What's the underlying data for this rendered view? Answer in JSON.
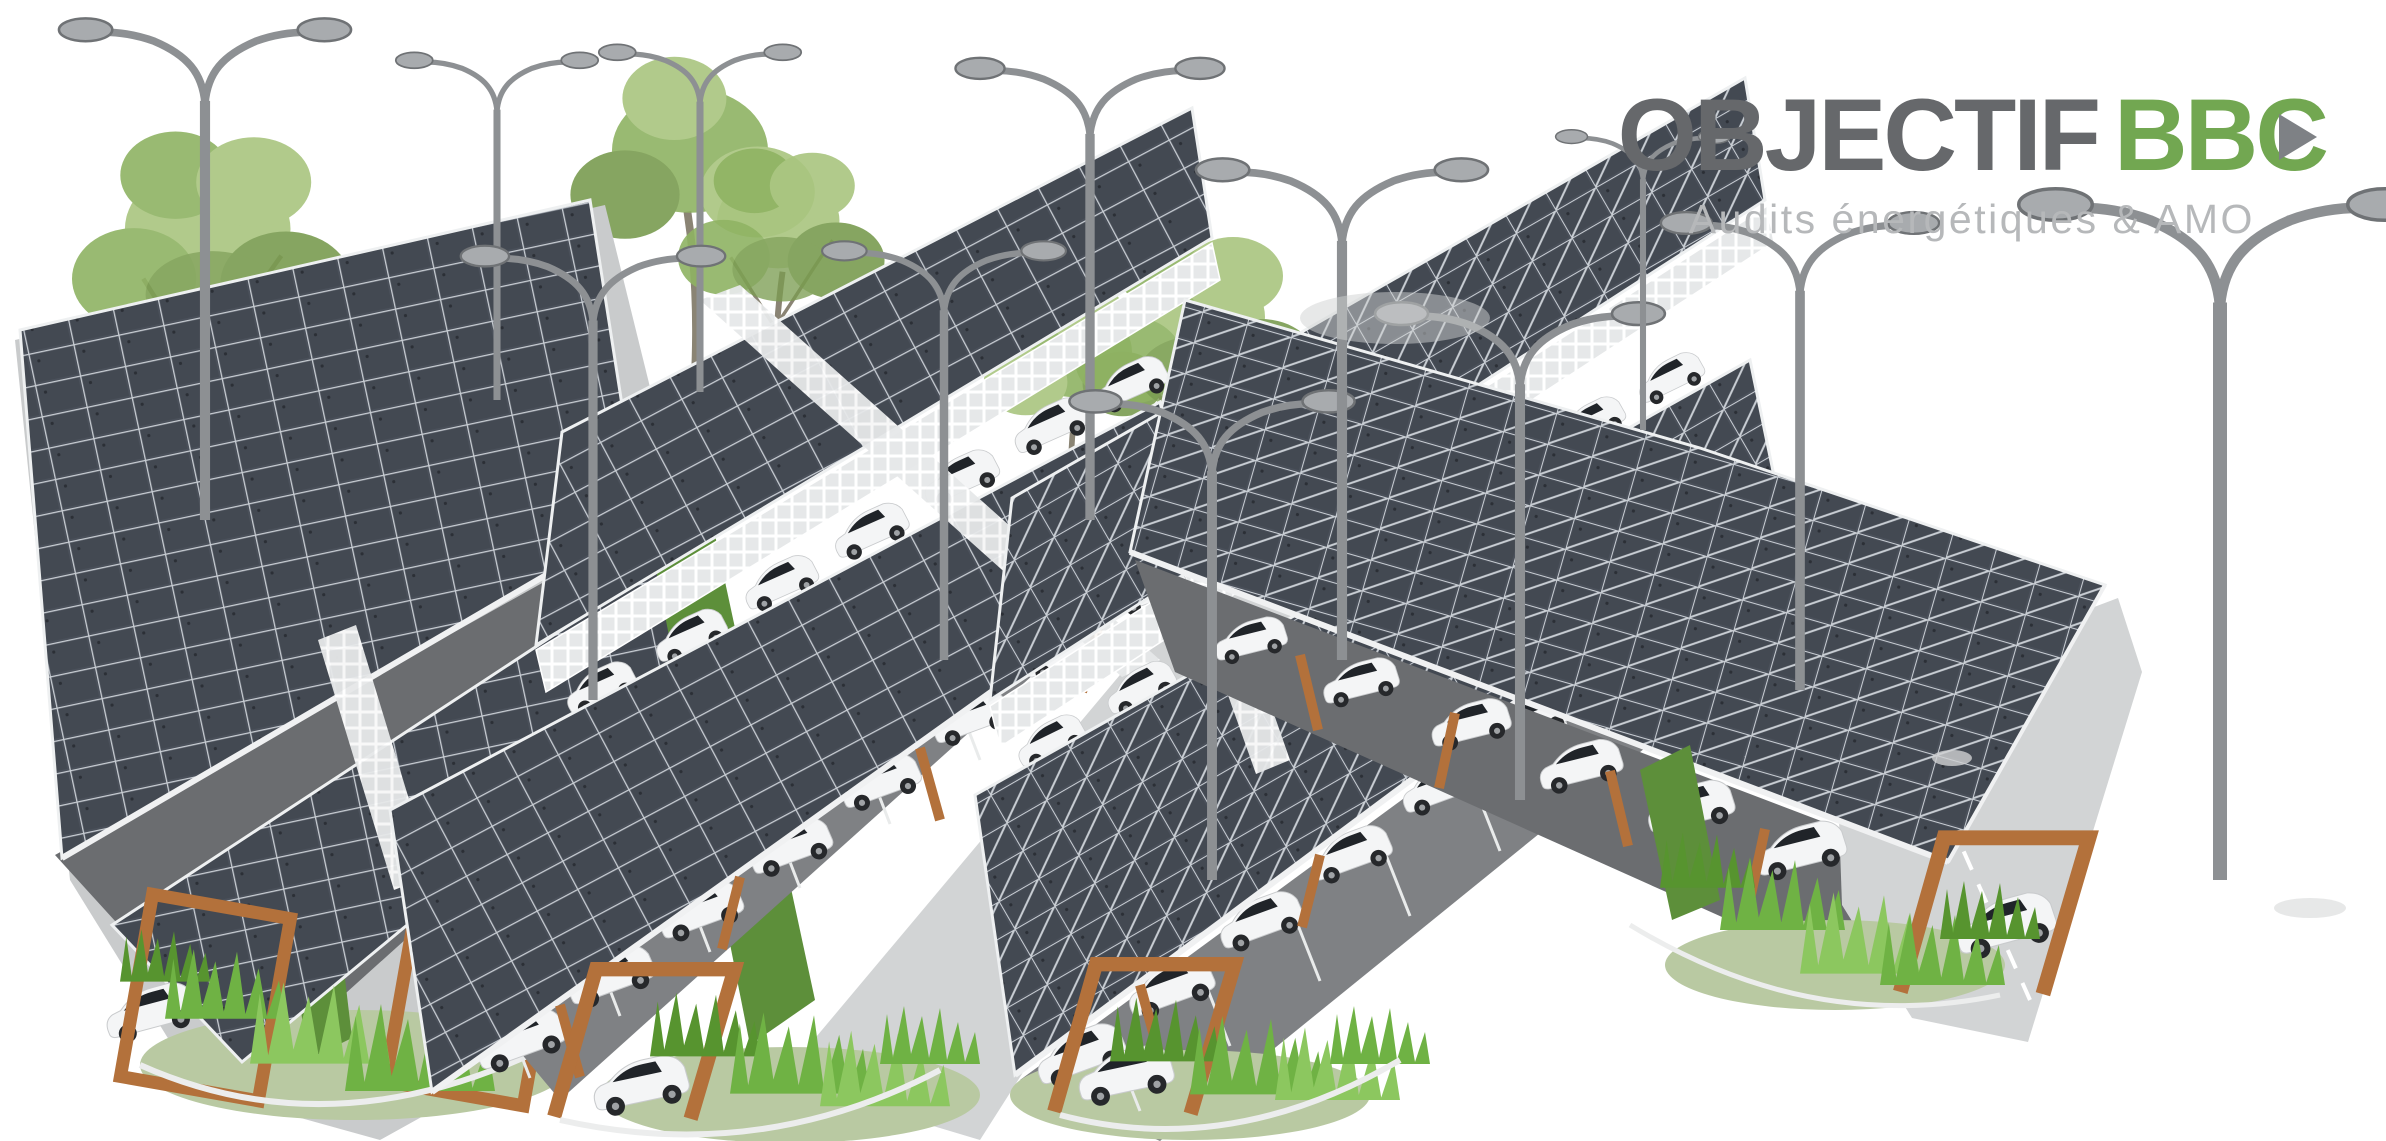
{
  "page": {
    "width_px": 2386,
    "height_px": 1141,
    "background": "#ffffff"
  },
  "logo": {
    "title_primary": "OBJECTIF",
    "title_accent_bb": "BB",
    "title_accent_c": "C",
    "title_full": "OBJECTIF BBC",
    "subtitle": "Audits énergétiques & AMO",
    "colors": {
      "gray": "#66686b",
      "green": "#72a751",
      "play": "#7e8185",
      "sub": "#b6b8ba"
    }
  },
  "scene": {
    "kind": "3d architectural rendering on white background",
    "subject": "photovoltaic carport canopies over a parking lot with white cars, trees, street lamps and ornamental grasses",
    "counts": {
      "carport_islands": 4,
      "solar_canopies": 7,
      "cars": 42,
      "street_lamps": 12,
      "trees": 7,
      "bush_clusters": 4
    },
    "palette": {
      "panel": "#4a505a",
      "panel_inner": "#434952",
      "panel_grid": "#c9ced4",
      "band_edge": "#eef0f1",
      "lattice": "#e6e8e9",
      "lattice_line": "#ffffff",
      "wood": "#b3713b",
      "lamp": "#8d9093",
      "lamp_head": "#a8abae",
      "ground": "#c9cbcc",
      "driveway": "#d2d4d5",
      "asphalt": "#7f8184",
      "asphalt_dark": "#6b6d70",
      "stall": "#e9ebeb",
      "curb": "#eceded",
      "hedge": "#5d8f3a",
      "mound": "#b9c9a2",
      "foliage_a": "#a9c57f",
      "foliage_b": "#8fb363",
      "foliage_c": "#7a9c50",
      "trunk": "#8a8474",
      "bush_a": "#6fb244",
      "bush_b": "#8cc75f",
      "bush_c": "#57942f",
      "car": "#f4f5f6",
      "car_glass": "#202429",
      "car_wheel": "#26282b",
      "car_hub": "#9fa2a5",
      "shadow": "#cfd1d2"
    }
  }
}
